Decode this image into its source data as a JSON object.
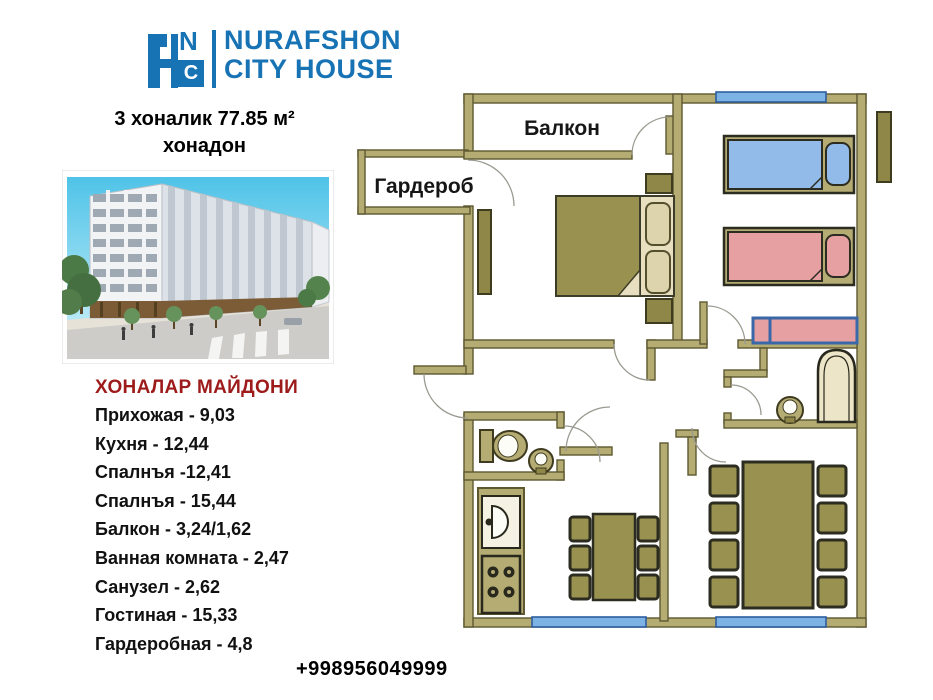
{
  "logo": {
    "monogram": {
      "n": "N",
      "h": "H",
      "c": "C"
    },
    "wordmark_line1": "NURAFSHON",
    "wordmark_line2": "CITY HOUSE",
    "color": "#1873b5"
  },
  "header": {
    "title_line1": "3 хоналик 77.85 м²",
    "title_line2": "хонадон"
  },
  "areas": {
    "heading": "ХОНАЛАР МАЙДОНИ",
    "heading_color": "#9e1b1b",
    "items": [
      "Прихожая - 9,03",
      "Кухня - 12,44",
      "Спалнъя -12,41",
      "Спалнъя - 15,44",
      "Балкон  - 3,24/1,62",
      "Ванная комната - 2,47",
      "Санузел - 2,62",
      "Гостиная  - 15,33",
      "Гардеробная - 4,8"
    ]
  },
  "floor_plan": {
    "labels": {
      "balcony": "Балкон",
      "wardrobe": "Гардероб"
    },
    "colors": {
      "wall": "#b5ac74",
      "wall_outline": "#5e5831",
      "furniture_olive": "#99914f",
      "window_blue": "#7db3e4",
      "bed_blue": "#92bbe9",
      "bed_pink": "#e7a0a2",
      "bench_frame_blue": "#3a67a8",
      "tub_cream": "#ece5c8"
    }
  },
  "contact": {
    "phone": "+998956049999"
  }
}
